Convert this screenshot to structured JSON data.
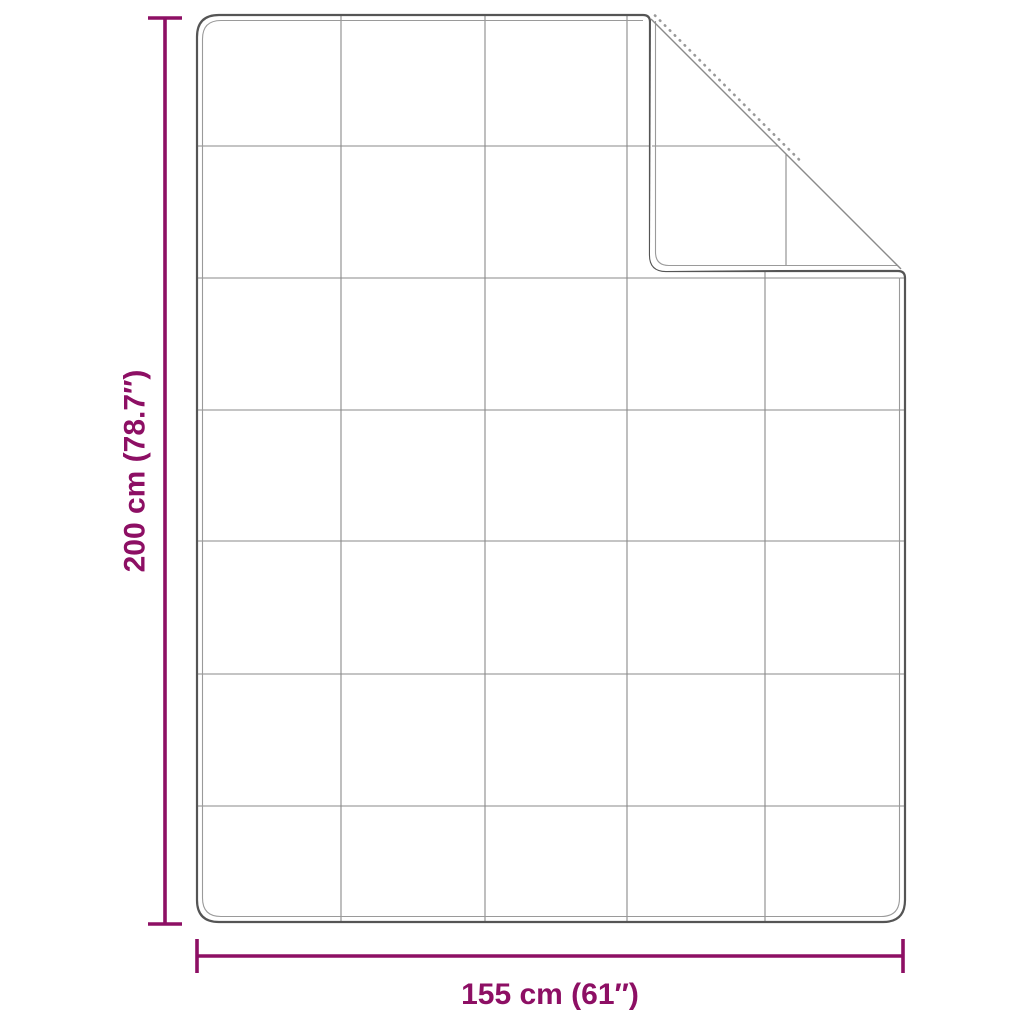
{
  "colors": {
    "background": "#ffffff",
    "accent": "#8d0f64",
    "outline": "#555555",
    "outline_light": "#9a9a9a",
    "grid": "#8a8a8a"
  },
  "dimensions": {
    "vertical": {
      "label": "200 cm (78.7″)",
      "cm": 200,
      "inches": 78.7
    },
    "horizontal": {
      "label": "155 cm (61″)",
      "cm": 155,
      "inches": 61
    }
  },
  "blanket": {
    "grid_columns": 5,
    "grid_rows": 7,
    "folded_corner": "top-right"
  }
}
